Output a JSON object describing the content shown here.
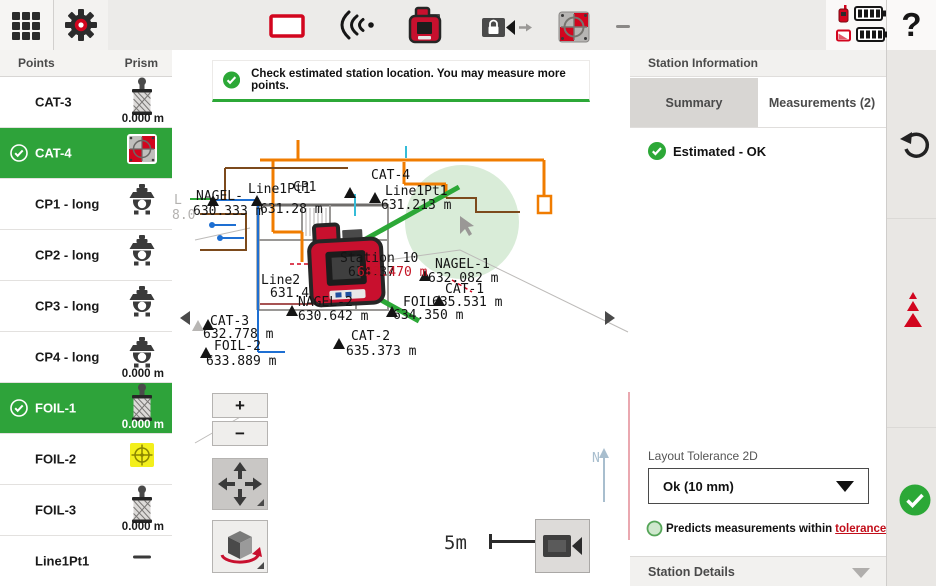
{
  "toolbar": {
    "help_label": "?",
    "icons": [
      "grid-menu",
      "settings-gear",
      "layout-rectangle",
      "signal-waves",
      "total-station",
      "camera-lock",
      "target-plate",
      "minimize-dash"
    ],
    "battery": {
      "station_level": 4,
      "tablet_level": 4
    }
  },
  "sidebar": {
    "columns": {
      "points": "Points",
      "prism": "Prism"
    },
    "items": [
      {
        "label": "CAT-3",
        "icon": "prism-360-icon",
        "offset": "0.000 m",
        "selected": false
      },
      {
        "label": "CAT-4",
        "icon": "target-plate-icon",
        "offset": "",
        "selected": true
      },
      {
        "label": "CP1 - long",
        "icon": "prism-long-icon",
        "offset": "",
        "selected": false
      },
      {
        "label": "CP2 - long",
        "icon": "prism-long-icon",
        "offset": "",
        "selected": false
      },
      {
        "label": "CP3 - long",
        "icon": "prism-long-icon",
        "offset": "",
        "selected": false
      },
      {
        "label": "CP4 - long",
        "icon": "prism-long-icon",
        "offset": "0.000 m",
        "selected": false
      },
      {
        "label": "FOIL-1",
        "icon": "prism-360-icon",
        "offset": "0.000 m",
        "selected": true
      },
      {
        "label": "FOIL-2",
        "icon": "target-yellow-icon",
        "offset": "",
        "selected": false
      },
      {
        "label": "FOIL-3",
        "icon": "prism-360-icon",
        "offset": "0.000 m",
        "selected": false
      },
      {
        "label": "Line1Pt1",
        "icon": "dash-icon",
        "offset": "",
        "selected": false
      }
    ]
  },
  "map": {
    "message": "Check estimated station location. You may measure more points.",
    "zoom_in_label": "+",
    "zoom_out_label": "−",
    "scale_label": "5m",
    "station_label": "Station 10",
    "cad_labels": [
      {
        "text": "NAGEL-",
        "x": 196,
        "y": 200
      },
      {
        "text": "630.333 m",
        "x": 193,
        "y": 215
      },
      {
        "text": "Line1Pt1",
        "x": 248,
        "y": 193
      },
      {
        "text": "CP1",
        "x": 293,
        "y": 191
      },
      {
        "text": "631.28 m",
        "x": 260,
        "y": 213
      },
      {
        "text": "CAT-4",
        "x": 371,
        "y": 179
      },
      {
        "text": "Line1Pt1",
        "x": 385,
        "y": 195
      },
      {
        "text": "631.213 m",
        "x": 381,
        "y": 209
      },
      {
        "text": "Station 10",
        "x": 340,
        "y": 262
      },
      {
        "text": "634.37",
        "x": 348,
        "y": 276
      },
      {
        "text": "633.470 m",
        "x": 357,
        "y": 276,
        "color": "#c41425"
      },
      {
        "text": "NAGEL-1",
        "x": 435,
        "y": 268
      },
      {
        "text": "632.082 m",
        "x": 428,
        "y": 282
      },
      {
        "text": "CAT-1",
        "x": 445,
        "y": 293
      },
      {
        "text": "FOIL-",
        "x": 403,
        "y": 306
      },
      {
        "text": "635.531 m",
        "x": 432,
        "y": 306
      },
      {
        "text": "634.350 m",
        "x": 393,
        "y": 319
      },
      {
        "text": "NAGEL-2",
        "x": 298,
        "y": 306
      },
      {
        "text": "630.642 m",
        "x": 298,
        "y": 320
      },
      {
        "text": "Line2",
        "x": 261,
        "y": 284
      },
      {
        "text": "631.4",
        "x": 270,
        "y": 297
      },
      {
        "text": "CAT-3",
        "x": 210,
        "y": 325
      },
      {
        "text": "632.778 m",
        "x": 203,
        "y": 338
      },
      {
        "text": "FOIL-2",
        "x": 214,
        "y": 350
      },
      {
        "text": "633.889 m",
        "x": 206,
        "y": 365
      },
      {
        "text": "CAT-2",
        "x": 351,
        "y": 340
      },
      {
        "text": "635.373 m",
        "x": 346,
        "y": 355
      },
      {
        "text": "L",
        "x": 174,
        "y": 204,
        "color": "#b4b2b0"
      },
      {
        "text": "8.0",
        "x": 172,
        "y": 219,
        "color": "#b4b2b0"
      }
    ],
    "triangles": [
      {
        "x": 375,
        "y": 203
      },
      {
        "x": 350,
        "y": 198
      },
      {
        "x": 257,
        "y": 206
      },
      {
        "x": 213,
        "y": 206
      },
      {
        "x": 425,
        "y": 281
      },
      {
        "x": 439,
        "y": 306
      },
      {
        "x": 392,
        "y": 317
      },
      {
        "x": 292,
        "y": 316
      },
      {
        "x": 208,
        "y": 330
      },
      {
        "x": 198,
        "y": 331,
        "color": "#b8b6b4"
      },
      {
        "x": 206,
        "y": 358
      },
      {
        "x": 339,
        "y": 349
      }
    ],
    "north_label": "N"
  },
  "right_panel": {
    "title": "Station Information",
    "tabs": [
      {
        "label": "Summary",
        "active": true
      },
      {
        "label": "Measurements (2)",
        "active": false
      }
    ],
    "status": "Estimated - OK",
    "tolerance_label": "Layout Tolerance 2D",
    "tolerance_value": "Ok (10 mm)",
    "note_text": "Predicts measurements within",
    "note_link": "tolerance",
    "details_label": "Station Details"
  },
  "colors": {
    "accent_green": "#2ca837",
    "selected_row_green": "#2ea33a",
    "hilti_red": "#d2051e",
    "link_red": "#c20e1a"
  }
}
